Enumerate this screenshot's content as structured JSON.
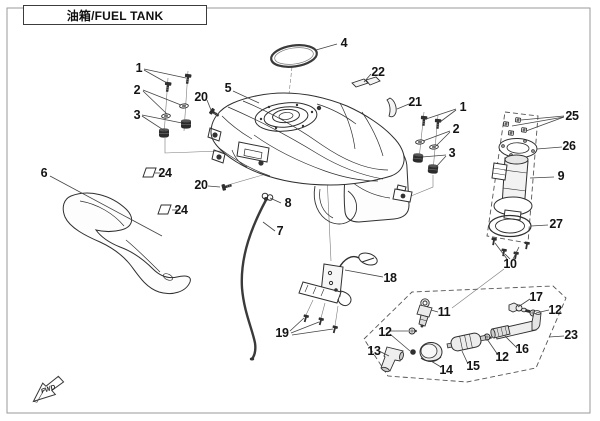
{
  "header": {
    "title": "油箱/FUEL TANK"
  },
  "fwd_label": "FWD",
  "colors": {
    "line": "#2f2f2f",
    "leader": "#444444",
    "page_border": "#9a9a9a",
    "background": "#ffffff"
  },
  "callouts": [
    {
      "text": "1",
      "x": 139,
      "y": 68
    },
    {
      "text": "2",
      "x": 137,
      "y": 90
    },
    {
      "text": "3",
      "x": 137,
      "y": 115
    },
    {
      "text": "20",
      "x": 201,
      "y": 97
    },
    {
      "text": "5",
      "x": 228,
      "y": 88
    },
    {
      "text": "4",
      "x": 344,
      "y": 43
    },
    {
      "text": "22",
      "x": 378,
      "y": 72
    },
    {
      "text": "21",
      "x": 415,
      "y": 102
    },
    {
      "text": "1",
      "x": 463,
      "y": 107
    },
    {
      "text": "2",
      "x": 456,
      "y": 129
    },
    {
      "text": "3",
      "x": 452,
      "y": 153
    },
    {
      "text": "25",
      "x": 572,
      "y": 116
    },
    {
      "text": "26",
      "x": 569,
      "y": 146
    },
    {
      "text": "9",
      "x": 561,
      "y": 176
    },
    {
      "text": "27",
      "x": 556,
      "y": 224
    },
    {
      "text": "10",
      "x": 510,
      "y": 264
    },
    {
      "text": "24",
      "x": 165,
      "y": 173
    },
    {
      "text": "24",
      "x": 181,
      "y": 210
    },
    {
      "text": "6",
      "x": 44,
      "y": 173
    },
    {
      "text": "20",
      "x": 201,
      "y": 185
    },
    {
      "text": "8",
      "x": 288,
      "y": 203
    },
    {
      "text": "7",
      "x": 280,
      "y": 231
    },
    {
      "text": "18",
      "x": 390,
      "y": 278
    },
    {
      "text": "19",
      "x": 282,
      "y": 333
    },
    {
      "text": "11",
      "x": 444,
      "y": 312
    },
    {
      "text": "12",
      "x": 385,
      "y": 332
    },
    {
      "text": "13",
      "x": 374,
      "y": 351
    },
    {
      "text": "14",
      "x": 446,
      "y": 370
    },
    {
      "text": "15",
      "x": 473,
      "y": 366
    },
    {
      "text": "12",
      "x": 502,
      "y": 357
    },
    {
      "text": "16",
      "x": 522,
      "y": 349
    },
    {
      "text": "12",
      "x": 555,
      "y": 310
    },
    {
      "text": "17",
      "x": 536,
      "y": 297
    },
    {
      "text": "23",
      "x": 571,
      "y": 335
    }
  ]
}
